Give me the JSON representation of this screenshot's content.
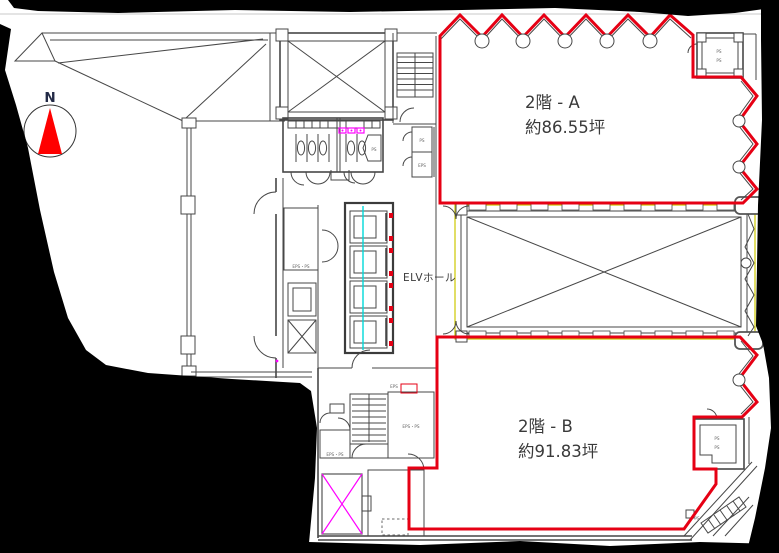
{
  "compass": {
    "label": "N"
  },
  "areas": {
    "a": {
      "name": "2階 - A",
      "size": "約86.55坪"
    },
    "b": {
      "name": "2階 - B",
      "size": "約91.83坪"
    }
  },
  "labels": {
    "elv_hall": "ELVホール",
    "ps": "PS",
    "eps": "EPS",
    "eps_ps": "EPS・PS"
  },
  "colors": {
    "lease_boundary_red": "#e60014",
    "compass_red": "#ff0000",
    "fixture_magenta": "#ff00ff",
    "elevator_cyan": "#00d8d8",
    "void_outline_yellow": "#cdc800",
    "plan_line_gray": "#474747",
    "torn_edge_black": "#000000"
  }
}
